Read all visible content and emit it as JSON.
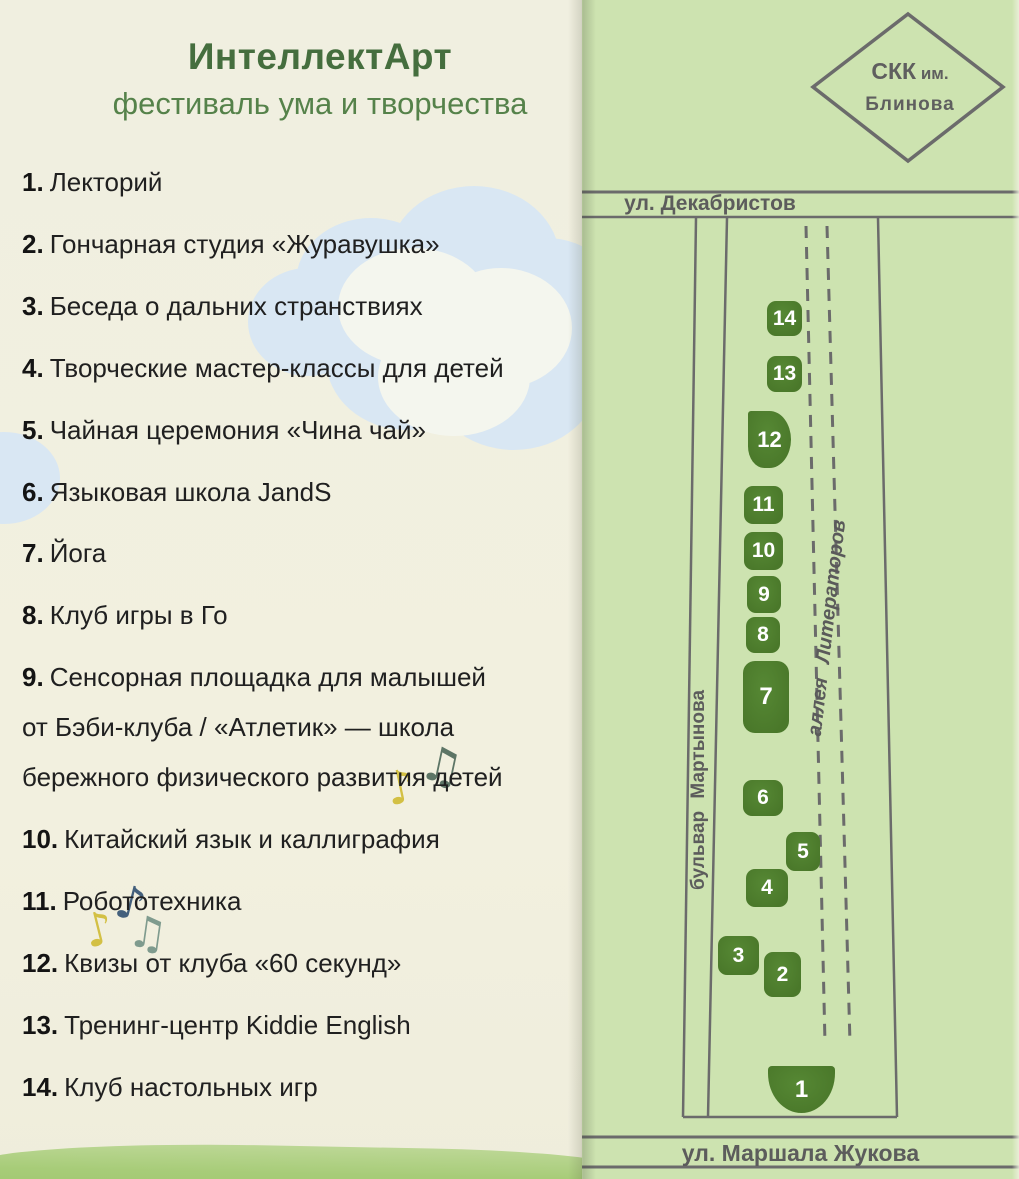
{
  "page": {
    "title": "ИнтеллектАрт",
    "subtitle": "фестиваль ума и творчества"
  },
  "venues": [
    {
      "num": "1.",
      "label": "Лекторий"
    },
    {
      "num": "2.",
      "label": "Гончарная студия «Журавушка»"
    },
    {
      "num": "3.",
      "label": "Беседа о дальних странствиях"
    },
    {
      "num": "4.",
      "label": "Творческие мастер-классы для детей"
    },
    {
      "num": "5.",
      "label": "Чайная церемония «Чина чай»"
    },
    {
      "num": "6.",
      "label": "Языковая школа JandS"
    },
    {
      "num": "7.",
      "label": "Йога"
    },
    {
      "num": "8.",
      "label": "Клуб игры в Го"
    },
    {
      "num": "9.",
      "label": "Сенсорная площадка для малышей\nот Бэби-клуба / «Атлетик» — школа\nбережного физического развития детей"
    },
    {
      "num": "10.",
      "label": "Китайский язык и каллиграфия"
    },
    {
      "num": "11.",
      "label": "Робототехника"
    },
    {
      "num": "12.",
      "label": "Квизы от клуба «60 секунд»"
    },
    {
      "num": "13.",
      "label": "Тренинг-центр Kiddie English"
    },
    {
      "num": "14.",
      "label": "Клуб настольных игр"
    }
  ],
  "map": {
    "landmark": {
      "name_main": "СКК",
      "name_suffix": " им.",
      "name_line2": "Блинова"
    },
    "streets": {
      "top": "ул. Декабристов",
      "bottom": "ул. Маршала Жукова",
      "left_boulevard": "бульвар Мартынова",
      "alley": "аллея Литераторов"
    },
    "markers": [
      {
        "label": "1"
      },
      {
        "label": "2"
      },
      {
        "label": "3"
      },
      {
        "label": "4"
      },
      {
        "label": "5"
      },
      {
        "label": "6"
      },
      {
        "label": "7"
      },
      {
        "label": "8"
      },
      {
        "label": "9"
      },
      {
        "label": "10"
      },
      {
        "label": "11"
      },
      {
        "label": "12"
      },
      {
        "label": "13"
      },
      {
        "label": "14"
      }
    ]
  },
  "decorations": {
    "note_single": "♪",
    "note_double": "♫"
  },
  "colors": {
    "marker_green": "#4a782a",
    "map_background": "#cde3b0",
    "title_green": "#456e3e",
    "subtitle_green": "#55824a",
    "road_gray": "#6b6b6b",
    "cloud_blue": "#d9e7f3",
    "grass_green": "#a7cc78",
    "note_yellow": "#d3c044",
    "note_navy": "#44607c",
    "note_teal": "#7f9b8e"
  }
}
